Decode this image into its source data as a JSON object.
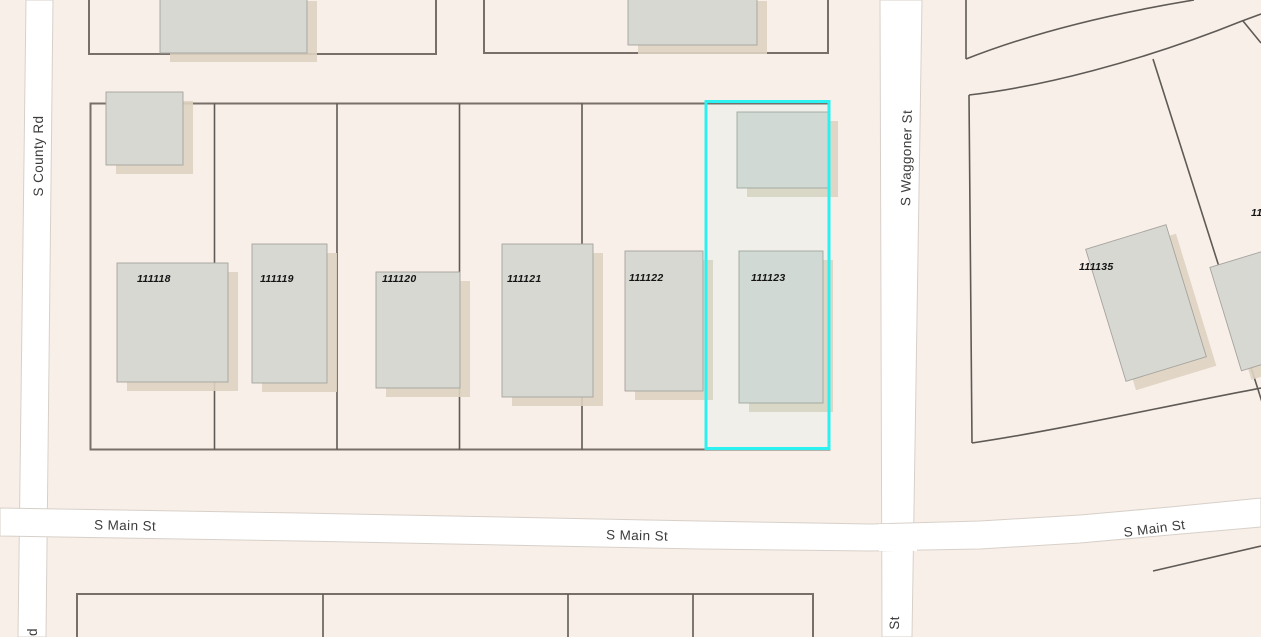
{
  "map": {
    "type": "parcel-gis-map",
    "background_color": "#f9efe9",
    "road_color": "#ffffff",
    "building_color": "#d8d8d3",
    "building_shadow_color": "#ded3c1",
    "parcel_line_color": "#6d6761",
    "selection_color": "#2bf1f1",
    "label_color": "#3c3c3c",
    "selected_parcel": "111123",
    "streets": {
      "left_vertical": "S County Rd",
      "right_vertical": "S Waggoner St",
      "horizontal_labels": [
        "S Main St",
        "S Main St",
        "S Main St"
      ],
      "partial_bottom_right": "St",
      "partial_bottom_left": "d"
    },
    "parcels": [
      {
        "id": "111118"
      },
      {
        "id": "111119"
      },
      {
        "id": "111120"
      },
      {
        "id": "111121"
      },
      {
        "id": "111122"
      },
      {
        "id": "111123"
      },
      {
        "id": "111135"
      },
      {
        "id": "11"
      }
    ]
  }
}
